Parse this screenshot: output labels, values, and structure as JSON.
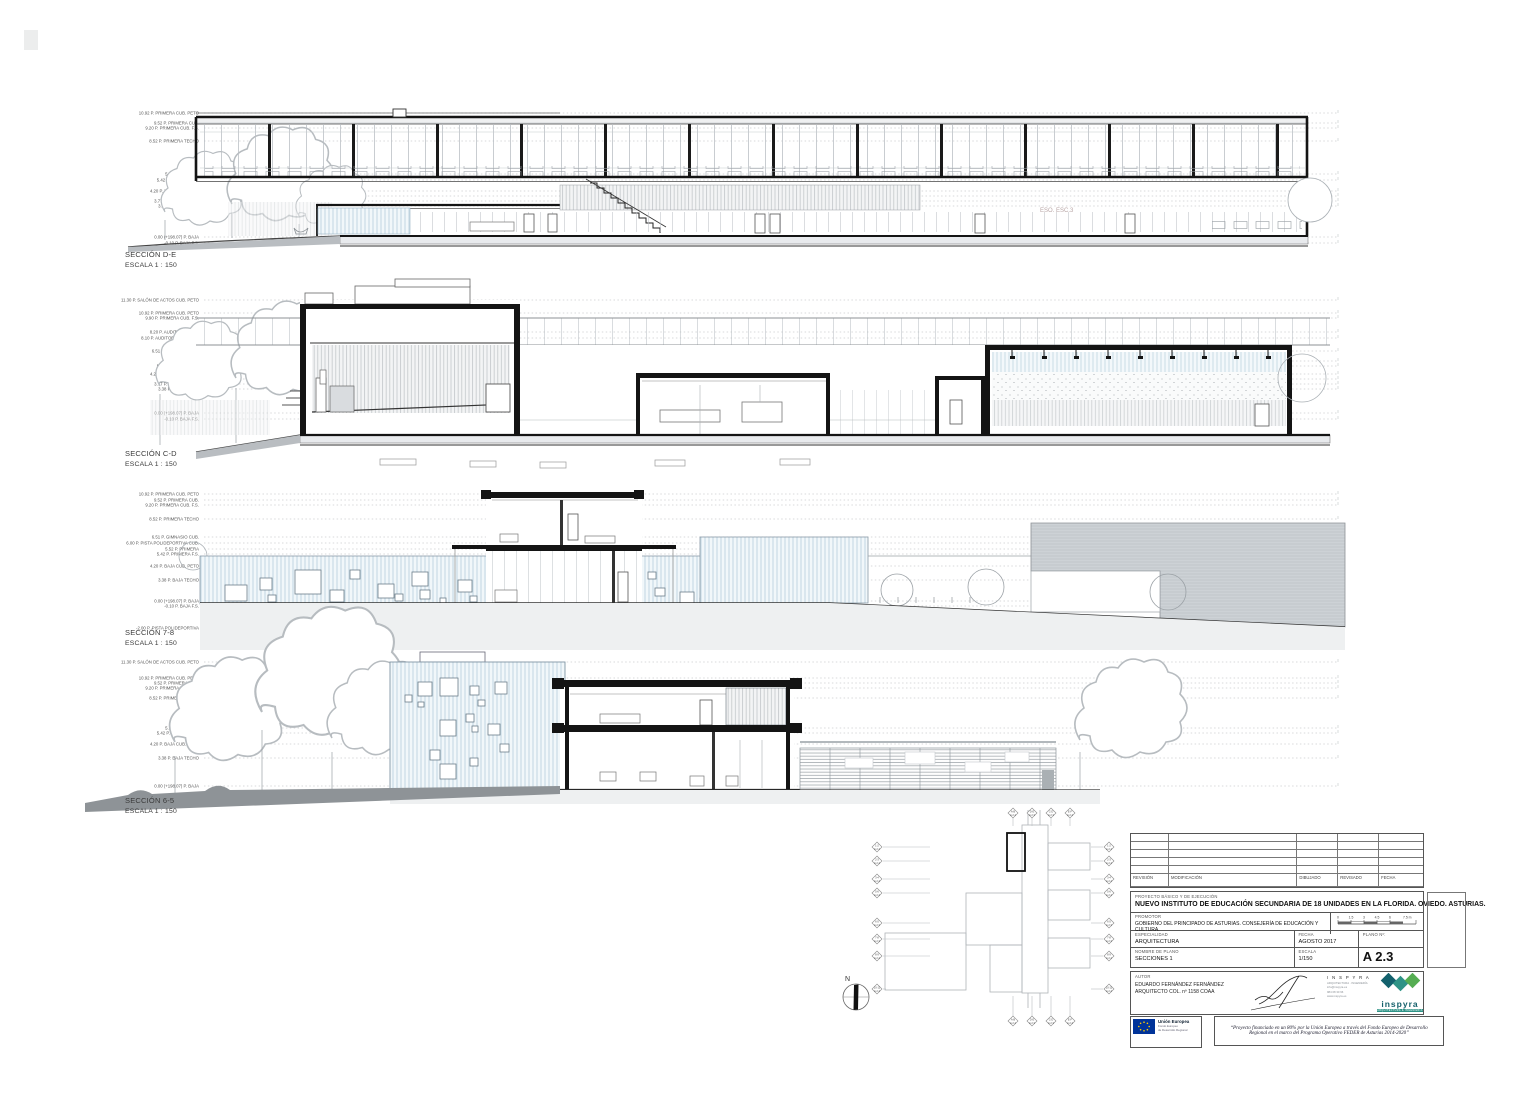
{
  "sections": [
    {
      "title": "SECCIÓN D-E",
      "scale": "ESCALA 1 : 150",
      "levels": [
        "10.92 P. PRIMERA CUB. PETO",
        "9.52 P. PRIMERA CUB.",
        "9.20 P. PRIMERA CUB. F.S.",
        "8.52 P. PRIMERA TECHO",
        "5.52 P. PRIMERA",
        "5.42 P. PRIMERA F.S.",
        "4.20 P. BAJA CUB. PETO",
        "4.08 P. BAJA CUB.",
        "3.77 P. BAJA CUB. F.S.",
        "3.38 P. BAJA TECHO",
        "0.00 (+198.07) P. BAJA",
        "-0.10 P. BAJA F.S."
      ]
    },
    {
      "title": "SECCIÓN C-D",
      "scale": "ESCALA 1 : 150",
      "levels": [
        "11.30 P. SALÓN DE ACTOS CUB. PETO",
        "10.92 P. PRIMERA CUB. PETO",
        "9.90 P. PRIMERA CUB. F.S.",
        "8.20 P. AUDITORIO CUB.",
        "8.10 P. AUDITORIO CUB. F.S.",
        "6.51 P. GIMNASIO CUB.",
        "5.52 P. PRIMERA",
        "5.42 P. PRIMERA F.S.",
        "4.20 P. BAJA CUB. PETO",
        "4.08 P. BAJA CUB.",
        "3.77 P. BAJA CUB. F.S.",
        "3.38 P. BAJA TECHO",
        "0.00 (+198.07) P. BAJA",
        "-0.10 P. BAJA F.S."
      ]
    },
    {
      "title": "SECCIÓN 7-8",
      "scale": "ESCALA 1 : 150",
      "levels": [
        "10.92 P. PRIMERA CUB. PETO",
        "9.52 P. PRIMERA CUB.",
        "9.20 P. PRIMERA CUB. F.S.",
        "8.52 P. PRIMERA TECHO",
        "6.51 P. GIMNASIO CUB.",
        "6.00 P. PISTA POLIDEPORTIVA CUB.",
        "5.52 P. PRIMERA",
        "5.42 P. PRIMERA F.S.",
        "4.20 P. BAJA CUB. PETO",
        "3.38 P. BAJA TECHO",
        "0.00 (+198.07) P. BAJA",
        "-0.10 P. BAJA F.S.",
        "-2.00 P. PISTA POLIDEPORTIVA"
      ]
    },
    {
      "title": "SECCIÓN 6-5",
      "scale": "ESCALA 1 : 150",
      "levels": [
        "11.30 P. SALÓN DE ACTOS CUB. PETO",
        "10.92 P. PRIMERA CUB. PETO",
        "9.52 P. PRIMERA CUB.",
        "9.20 P. PRIMERA CUB. F.S.",
        "8.52 P. PRIMERA TECHO",
        "5.52 P. PRIMERA",
        "5.42 P. PRIMERA F.S.",
        "4.20 P. BAJA CUB. PETO",
        "3.38 P. BAJA TECHO",
        "0.00 (+198.07) P. BAJA"
      ]
    }
  ],
  "annotations": {
    "eso_label": "ESO. ESC.3"
  },
  "keyplan": {
    "north_label": "N",
    "markers_top": [
      {
        "id": "A-B",
        "sheet": "A 2.4"
      },
      {
        "id": "D-E",
        "sheet": "A 2.3"
      },
      {
        "id": "C-D",
        "sheet": "A 2.3"
      },
      {
        "id": "E-F",
        "sheet": "A 2.4"
      }
    ],
    "markers_bottom": [
      {
        "id": "A-B",
        "sheet": "A 2.4"
      },
      {
        "id": "D-E",
        "sheet": "A 2.3"
      },
      {
        "id": "C-D",
        "sheet": "A 2.3"
      },
      {
        "id": "E-F",
        "sheet": "A 2.4"
      }
    ],
    "markers_left": [
      {
        "id": "1-2",
        "sheet": "A 2.4"
      },
      {
        "id": "2-3",
        "sheet": "A 2.4"
      },
      {
        "id": "3-4",
        "sheet": "A 2.4"
      },
      {
        "id": "5-6",
        "sheet": "A 2.4"
      },
      {
        "id": "6-5",
        "sheet": "A 2.3"
      },
      {
        "id": "7-8",
        "sheet": "A 2.3"
      },
      {
        "id": "8-9",
        "sheet": "A 2.4"
      },
      {
        "id": "10-11",
        "sheet": "A 2.4"
      }
    ],
    "markers_right": [
      {
        "id": "1-2",
        "sheet": "A 2.4"
      },
      {
        "id": "2-3",
        "sheet": "A 2.4"
      },
      {
        "id": "3-4",
        "sheet": "A 2.4"
      },
      {
        "id": "5-6",
        "sheet": "A 2.4"
      },
      {
        "id": "6-5",
        "sheet": "A 2.3"
      },
      {
        "id": "7-8",
        "sheet": "A 2.3"
      },
      {
        "id": "8-9",
        "sheet": "A 2.4"
      },
      {
        "id": "10-11",
        "sheet": "A 2.4"
      }
    ]
  },
  "titleblock": {
    "revision_headers": [
      "REVISIÓN",
      "MODIFICACIÓN",
      "DIBUJADO",
      "REVISADO",
      "FECHA"
    ],
    "project_type_label": "PROYECTO BÁSICO Y DE EJECUCIÓN",
    "project_title": "NUEVO INSTITUTO DE EDUCACIÓN SECUNDARIA DE 18 UNIDADES EN LA FLORIDA. OVIEDO. ASTURIAS.",
    "promotor_label": "PROMOTOR",
    "promotor": "GOBIERNO DEL PRINCIPADO DE ASTURIAS. CONSEJERÍA DE EDUCACIÓN Y CULTURA.",
    "scalebar_ticks": [
      "0",
      "1.5",
      "3",
      "4.5",
      "6",
      "7.5 m"
    ],
    "especialidad_label": "ESPECIALIDAD",
    "especialidad": "ARQUITECTURA",
    "fecha_label": "FECHA",
    "fecha": "AGOSTO 2017",
    "plano_no_label": "PLANO Nº:",
    "nombre_label": "NOMBRE DE PLANO",
    "nombre": "SECCIONES 1",
    "escala_label": "ESCALA",
    "escala": "1/150",
    "plano_no": "A 2.3",
    "autor_label": "AUTOR",
    "autor_line1": "EDUARDO FERNÁNDEZ FERNÁNDEZ",
    "autor_line2": "ARQUITECTO COL. nº 1158 COAA",
    "inspyra_name": "I N S P Y R A",
    "inspyra_sub": "ARQUITECTURA · INGENIERÍA",
    "inspyra_contact1": "info@inspyra.es",
    "inspyra_contact2": "984 08 30 96",
    "inspyra_web": "www.inspyra.es",
    "inspyra_wordmark": "inspyra",
    "inspyra_strip": "ARQUITECTURA & INGENIERÍA"
  },
  "eu": {
    "name": "Unión Europea",
    "sub1": "Fondo Europeo",
    "sub2": "de Desarrollo Regional",
    "quote": "“Proyecto financiado en un 80% por la Unión Europea a través del Fondo Europeo de Desarrollo Regional en el marco del Programa Operativo FEDER de Asturias 2014-2020”"
  },
  "colors": {
    "inspyra_dark": "#13616d",
    "inspyra_mid": "#2e9386",
    "inspyra_green": "#55ad52",
    "eu_blue": "#003399",
    "eu_star": "#ffcc00",
    "cut_poche": "#141414",
    "blue_hatch": "#bcd3e0"
  }
}
